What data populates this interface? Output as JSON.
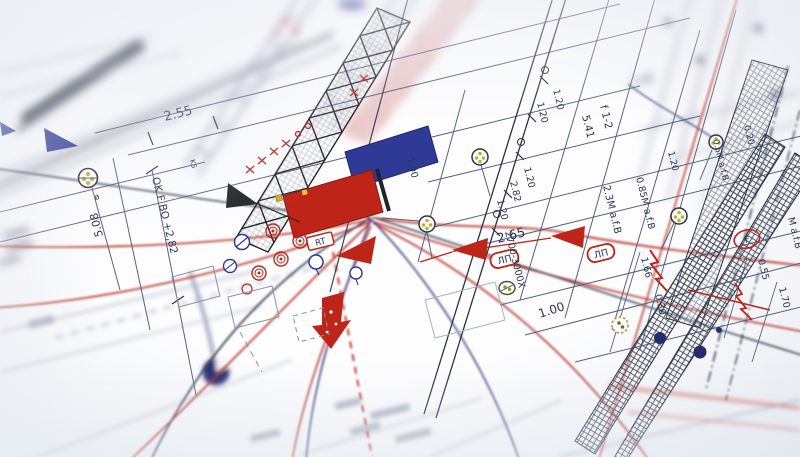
{
  "scene": {
    "kind": "photograph of a construction / site plan (blueprint) at an oblique angle, shallow depth of field"
  },
  "colors": {
    "red": "#b5291e",
    "deep_red": "#bf2418",
    "blue": "#2e3a96",
    "navy_ink": "#2b3246",
    "line_ink": "#55617c",
    "yellow_marker": "#b9b23a",
    "paper": "#f7f8fa"
  },
  "labels": {
    "dim_255": "2.55",
    "ks": "KS",
    "elev_ok": "OK F BO +2,82",
    "dim_508": "5.08",
    "diam": "ø",
    "f12": "f 1-2",
    "dim_541": "5.41",
    "dim_120a": "1.20",
    "dim_120b": "1.20",
    "dim_120c": "1.20",
    "dim_282": "2.82",
    "dim_120d": "1.20",
    "dim_120e": "1.20",
    "range_x": "2700-3000X",
    "afb_23": "2.3M a.f.B",
    "afb_085": "0.85M a.f.B",
    "afb_06": "0.6M a.f.B",
    "afb_right": "M a.f.B",
    "dim_020": "0.20",
    "dim_348": "3.48",
    "dim_100a": "1.00",
    "dim_265": "2.65",
    "dim_100b": "1.00",
    "ap1": "ЛП",
    "ap2": "ЛП",
    "rt": "RT",
    "dim_166": "1.66",
    "dim_030": "0.30",
    "dim_055": "0.55",
    "dim_170": "1.70",
    "f_marker": "F"
  }
}
